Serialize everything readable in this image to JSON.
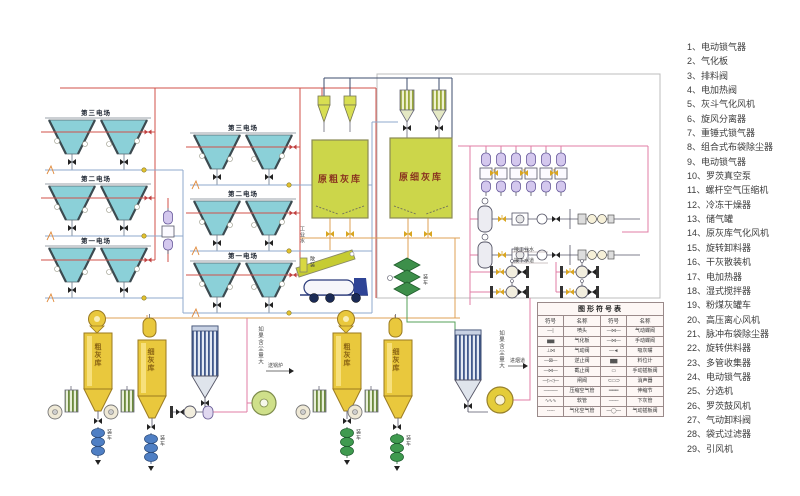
{
  "legend": {
    "items": [
      "1、电动锁气器",
      "2、气化板",
      "3、排料阀",
      "4、电加热阀",
      "5、灰斗气化风机",
      "6、旋风分离器",
      "7、重锤式锁气器",
      "8、组合式布袋除尘器",
      "9、电动锁气器",
      "10、罗茨真空泵",
      "11、螺杆空气压缩机",
      "12、冷冻干燥器",
      "13、储气罐",
      "14、原灰库气化风机",
      "15、旋转卸料器",
      "16、干灰散装机",
      "17、电加热器",
      "18、湿式搅拌器",
      "19、粉煤灰罐车",
      "20、高压离心风机",
      "21、脉冲布袋除尘器",
      "22、旋转供料器",
      "23、多管收集器",
      "24、电动锁气器",
      "25、分选机",
      "26、罗茨鼓风机",
      "27、气动卸料阀",
      "28、袋式过滤器",
      "29、引风机"
    ]
  },
  "symbol_table": {
    "title": "图形符号表",
    "headers": [
      "符号",
      "名称",
      "符号",
      "名称"
    ],
    "rows": [
      {
        "ls": "—∣",
        "ll": "喷头",
        "rs": "—⋈—",
        "rl": "气动蝶阀"
      },
      {
        "ls": "▅▅",
        "ll": "气化板",
        "rs": "—⋈—",
        "rl": "手动蝶阀"
      },
      {
        "ls": "⊥⋈",
        "ll": "气动阀",
        "rs": "—◄",
        "rl": "吸灰嘴"
      },
      {
        "ls": "—⊠—",
        "ll": "逆止阀",
        "rs": "▆▆",
        "rl": "料位计"
      },
      {
        "ls": "—⋈—",
        "ll": "截止阀",
        "rs": "▭",
        "rl": "手动插板阀"
      },
      {
        "ls": "—▷◁—",
        "ll": "闸阀",
        "rs": "⊂▭⊃",
        "rl": "消声器"
      },
      {
        "ls": "———",
        "ll": "压缩空气管",
        "rs": "═══",
        "rl": "伸缩节"
      },
      {
        "ls": "∿∿∿",
        "ll": "软管",
        "rs": "───",
        "rl": "下灰管"
      },
      {
        "ls": "╌╌╌",
        "ll": "气化空气管",
        "rs": "—◯—",
        "rl": "气动插板阀"
      }
    ]
  },
  "esp": {
    "fields": [
      "第三电场",
      "第二电场",
      "第一电场"
    ]
  },
  "silos": {
    "raw_coarse": "原粗灰库",
    "raw_fine": "原细灰库",
    "coarse": "粗灰库",
    "fine": "细灰库"
  },
  "labels": {
    "industrial_water": "工业水",
    "connect_industrial_water": "接工业水",
    "connect_sewer": "接下水道",
    "high_dust_note": "如果含尘量大",
    "to_boiler": "送锅炉",
    "to_flue": "进烟道",
    "load_truck": "装车",
    "bulk_load": "散装"
  },
  "palette": {
    "pipe_red": "#d0504a",
    "pipe_pink": "#e07ca6",
    "pipe_blue": "#8fa9cc",
    "pipe_navy": "#3e4c6e",
    "pipe_orange": "#dfa055",
    "pipe_green": "#56a058",
    "hopper_teal": "#8bd0d8",
    "silo_yellow_green": "#ccd64a",
    "silo_gold": "#e9c83d"
  }
}
